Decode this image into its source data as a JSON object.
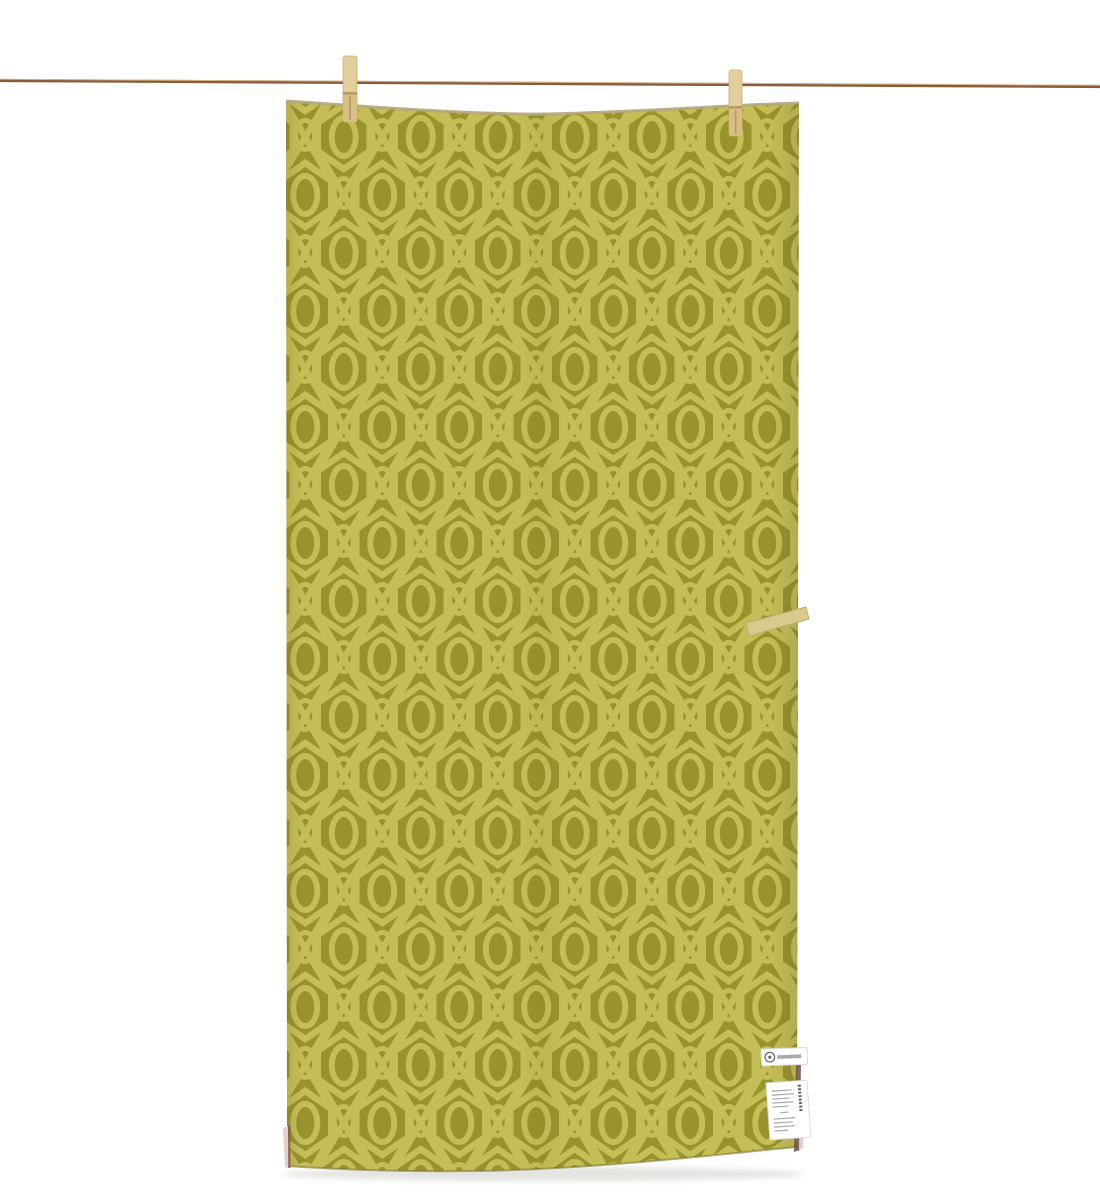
{
  "photo": {
    "description": "Olive green geometric-patterned towel hanging on a clothesline with two wooden clothespins",
    "background_color": "#ffffff",
    "rope": {
      "color": "#8a5c39",
      "highlight_color": "#d8bb97"
    },
    "pins": {
      "count": 2,
      "body_color": "#e3cf9c",
      "lower_color": "#d6bd82",
      "hardware_color": "#b2955c"
    },
    "towel": {
      "base_color": "#99932d",
      "pattern_color": "#c4be57",
      "pattern_name": "interlocking-x-and-oval-hexagon-lattice",
      "top_hem_color": "#b3a67c",
      "bottom_edge_color": "#7e7837",
      "side_dark_color": "#6b5047",
      "underside_color": "#e4d0ca",
      "loop_color": "#d8c98d"
    },
    "labels": {
      "brand": {
        "bg": "#ffffff",
        "logo_color": "#666666",
        "text_color": "#8f8f8f"
      },
      "care": {
        "bg": "#ffffff",
        "heading_color": "#6d5c5c",
        "line_color": "#a9a9a9"
      }
    }
  }
}
